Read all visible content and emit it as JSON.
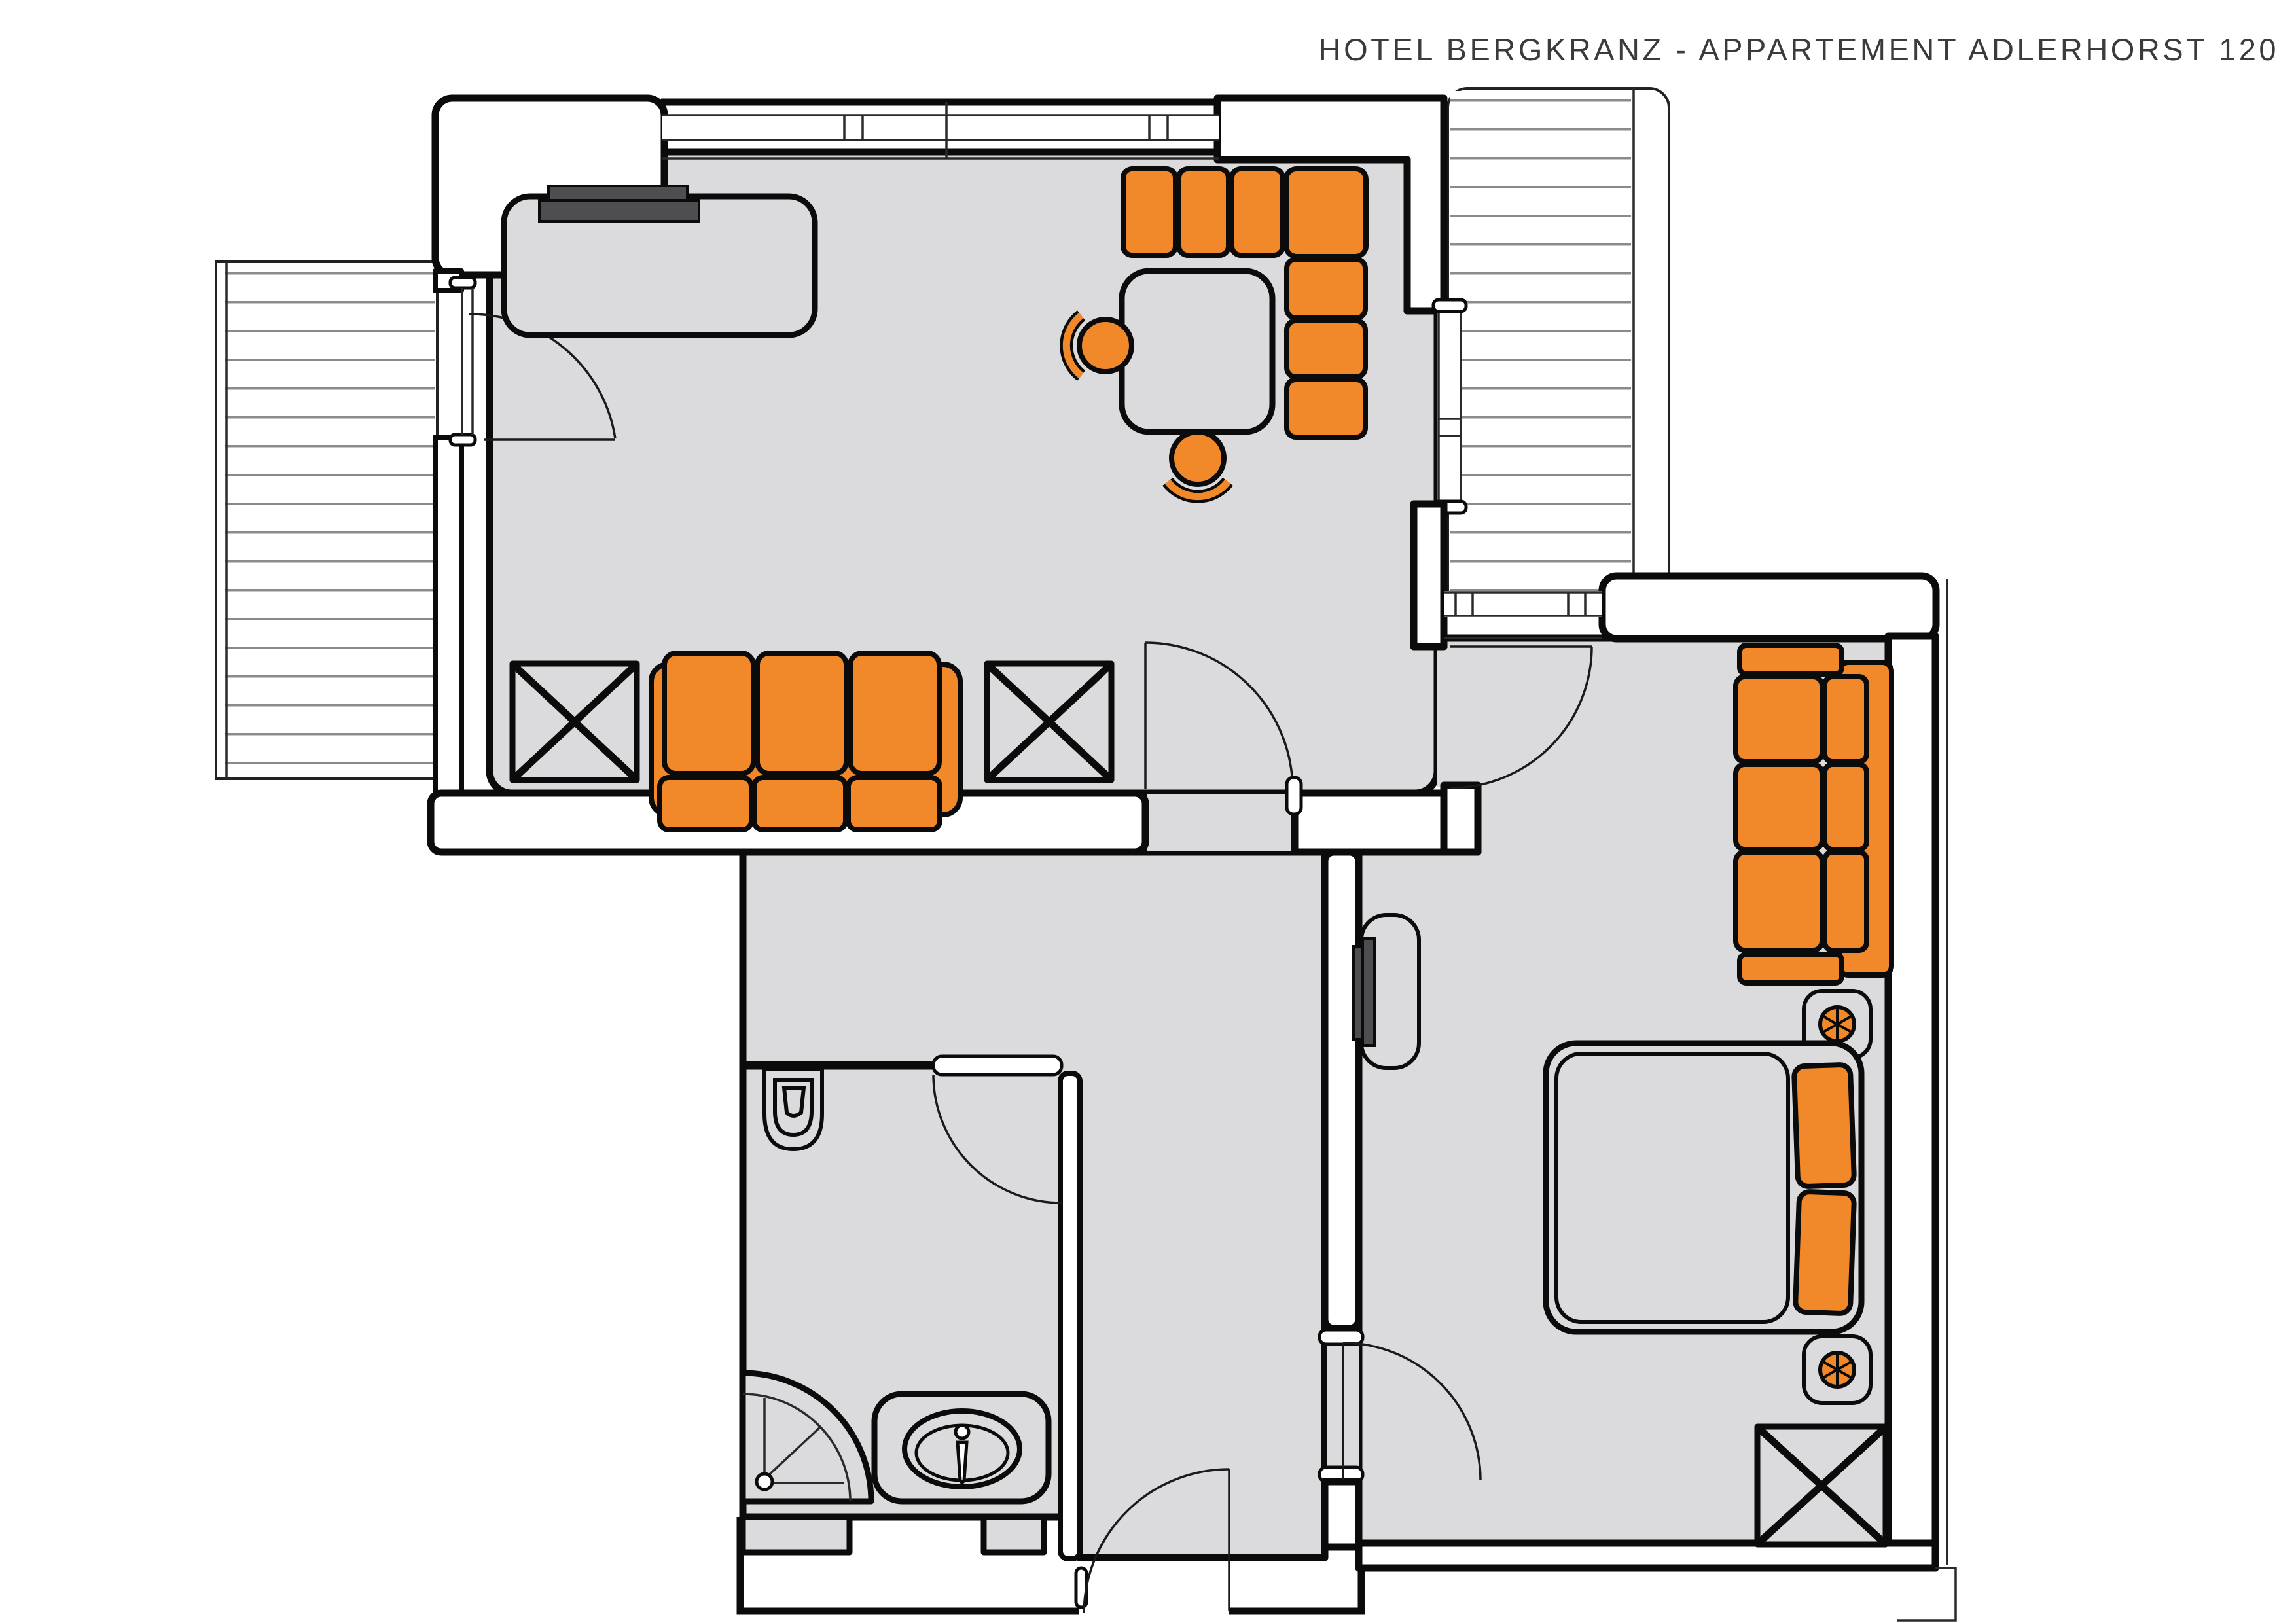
{
  "header": {
    "title": "HOTEL BERGKRANZ - APPARTEMENT ADLERHORST 120"
  },
  "palette": {
    "accent_orange": "#F1892B",
    "floor_gray": "#DBDBDD",
    "wall_fill": "#FFFFFF",
    "line_black": "#0B0B0B",
    "tv_dark_gray": "#4E4E50",
    "deck_line_gray": "#8B8B8B",
    "title_text": "#3B3B3B",
    "background": "#FFFFFF"
  },
  "floorplan": {
    "rooms": [
      {
        "name": "living-room",
        "furniture": [
          "sideboard-with-tv",
          "corner-bench-7-cushions",
          "square-dining-table",
          "dining-chair",
          "dining-chair",
          "three-seat-sofa",
          "wardrobe-x-box",
          "wardrobe-x-box"
        ]
      },
      {
        "name": "hallway",
        "furniture": []
      },
      {
        "name": "bathroom",
        "furniture": [
          "toilet",
          "corner-shower",
          "washbasin-counter"
        ]
      },
      {
        "name": "bedroom",
        "furniture": [
          "three-seat-sofa",
          "nightstand-with-lamp",
          "double-bed-two-pillows",
          "nightstand-with-lamp",
          "sideboard-with-tv",
          "wardrobe-x-box"
        ]
      }
    ],
    "balconies": [
      "balcony-left-decking",
      "balcony-right-decking"
    ],
    "doors": [
      "balcony-door",
      "living-to-hall-door",
      "bedroom-upper-door",
      "bedroom-lower-door",
      "bathroom-door",
      "apartment-entry-door"
    ],
    "windows": [
      "living-top-window",
      "living-right-window",
      "bedroom-top-window"
    ]
  }
}
